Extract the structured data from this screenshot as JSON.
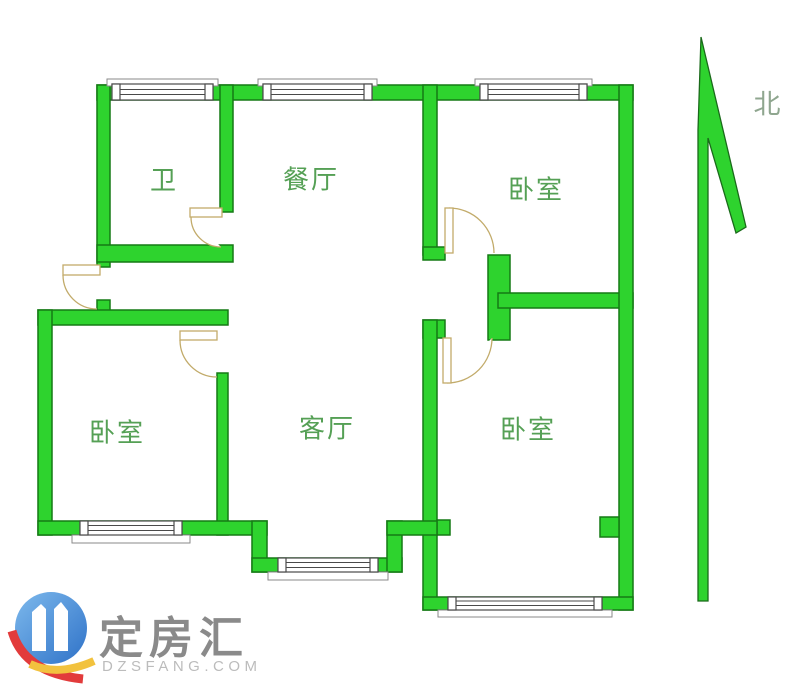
{
  "floorplan": {
    "rooms": [
      {
        "id": "bathroom",
        "label": "卫"
      },
      {
        "id": "dining-room",
        "label": "餐厅"
      },
      {
        "id": "bedroom-top-right",
        "label": "卧室"
      },
      {
        "id": "bedroom-bottom-left",
        "label": "卧室"
      },
      {
        "id": "living-room",
        "label": "客厅"
      },
      {
        "id": "bedroom-bottom-right",
        "label": "卧室"
      }
    ],
    "compass": {
      "label": "北"
    }
  },
  "watermark": {
    "brand": "定房汇",
    "site": "DZSFANG.COM"
  },
  "colors": {
    "wall_fill": "#2ed32e",
    "wall_outline": "#157a15",
    "room_label": "#55a055",
    "compass_label": "#8fa68f",
    "door_line": "#c2ab6a",
    "window_line": "#4a4a4a",
    "logo_blue": "#3a86d4",
    "logo_red": "#e23b3b",
    "logo_yellow": "#f2c23e",
    "brand_gray": "#8a8a8a"
  }
}
